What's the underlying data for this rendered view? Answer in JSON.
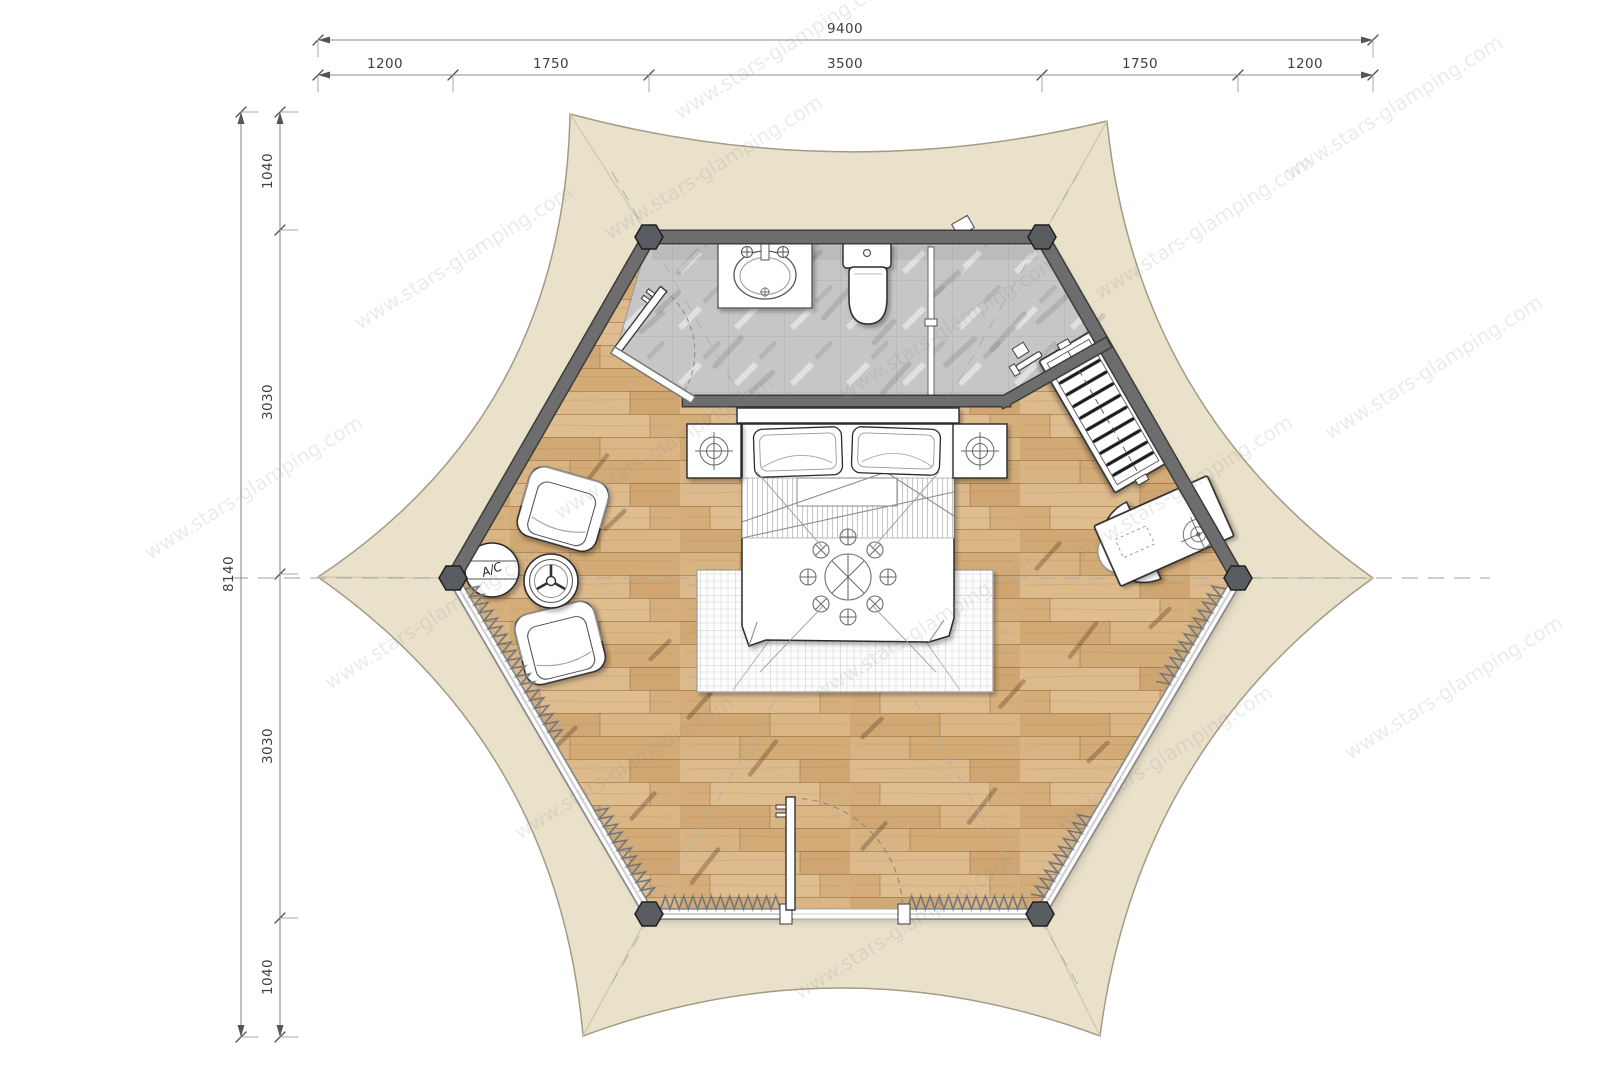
{
  "watermark": {
    "text": "www.stars-glamping.com"
  },
  "dimensions": {
    "horizontal": {
      "total": "9400",
      "segments": [
        "1200",
        "1750",
        "3500",
        "1750",
        "1200"
      ]
    },
    "vertical": {
      "total": "8140",
      "segments": [
        "1040",
        "3030",
        "3030",
        "1040"
      ]
    }
  },
  "labels": {
    "ac_unit": "A/C"
  },
  "colors": {
    "canvas": "#eae1ca",
    "wall_dark": "#6d6d6d",
    "wood_floor": "#d8b585",
    "bath_tile": "#c6c6c6",
    "furniture": "#ffffff",
    "dimension_line": "#8c8c8c"
  }
}
